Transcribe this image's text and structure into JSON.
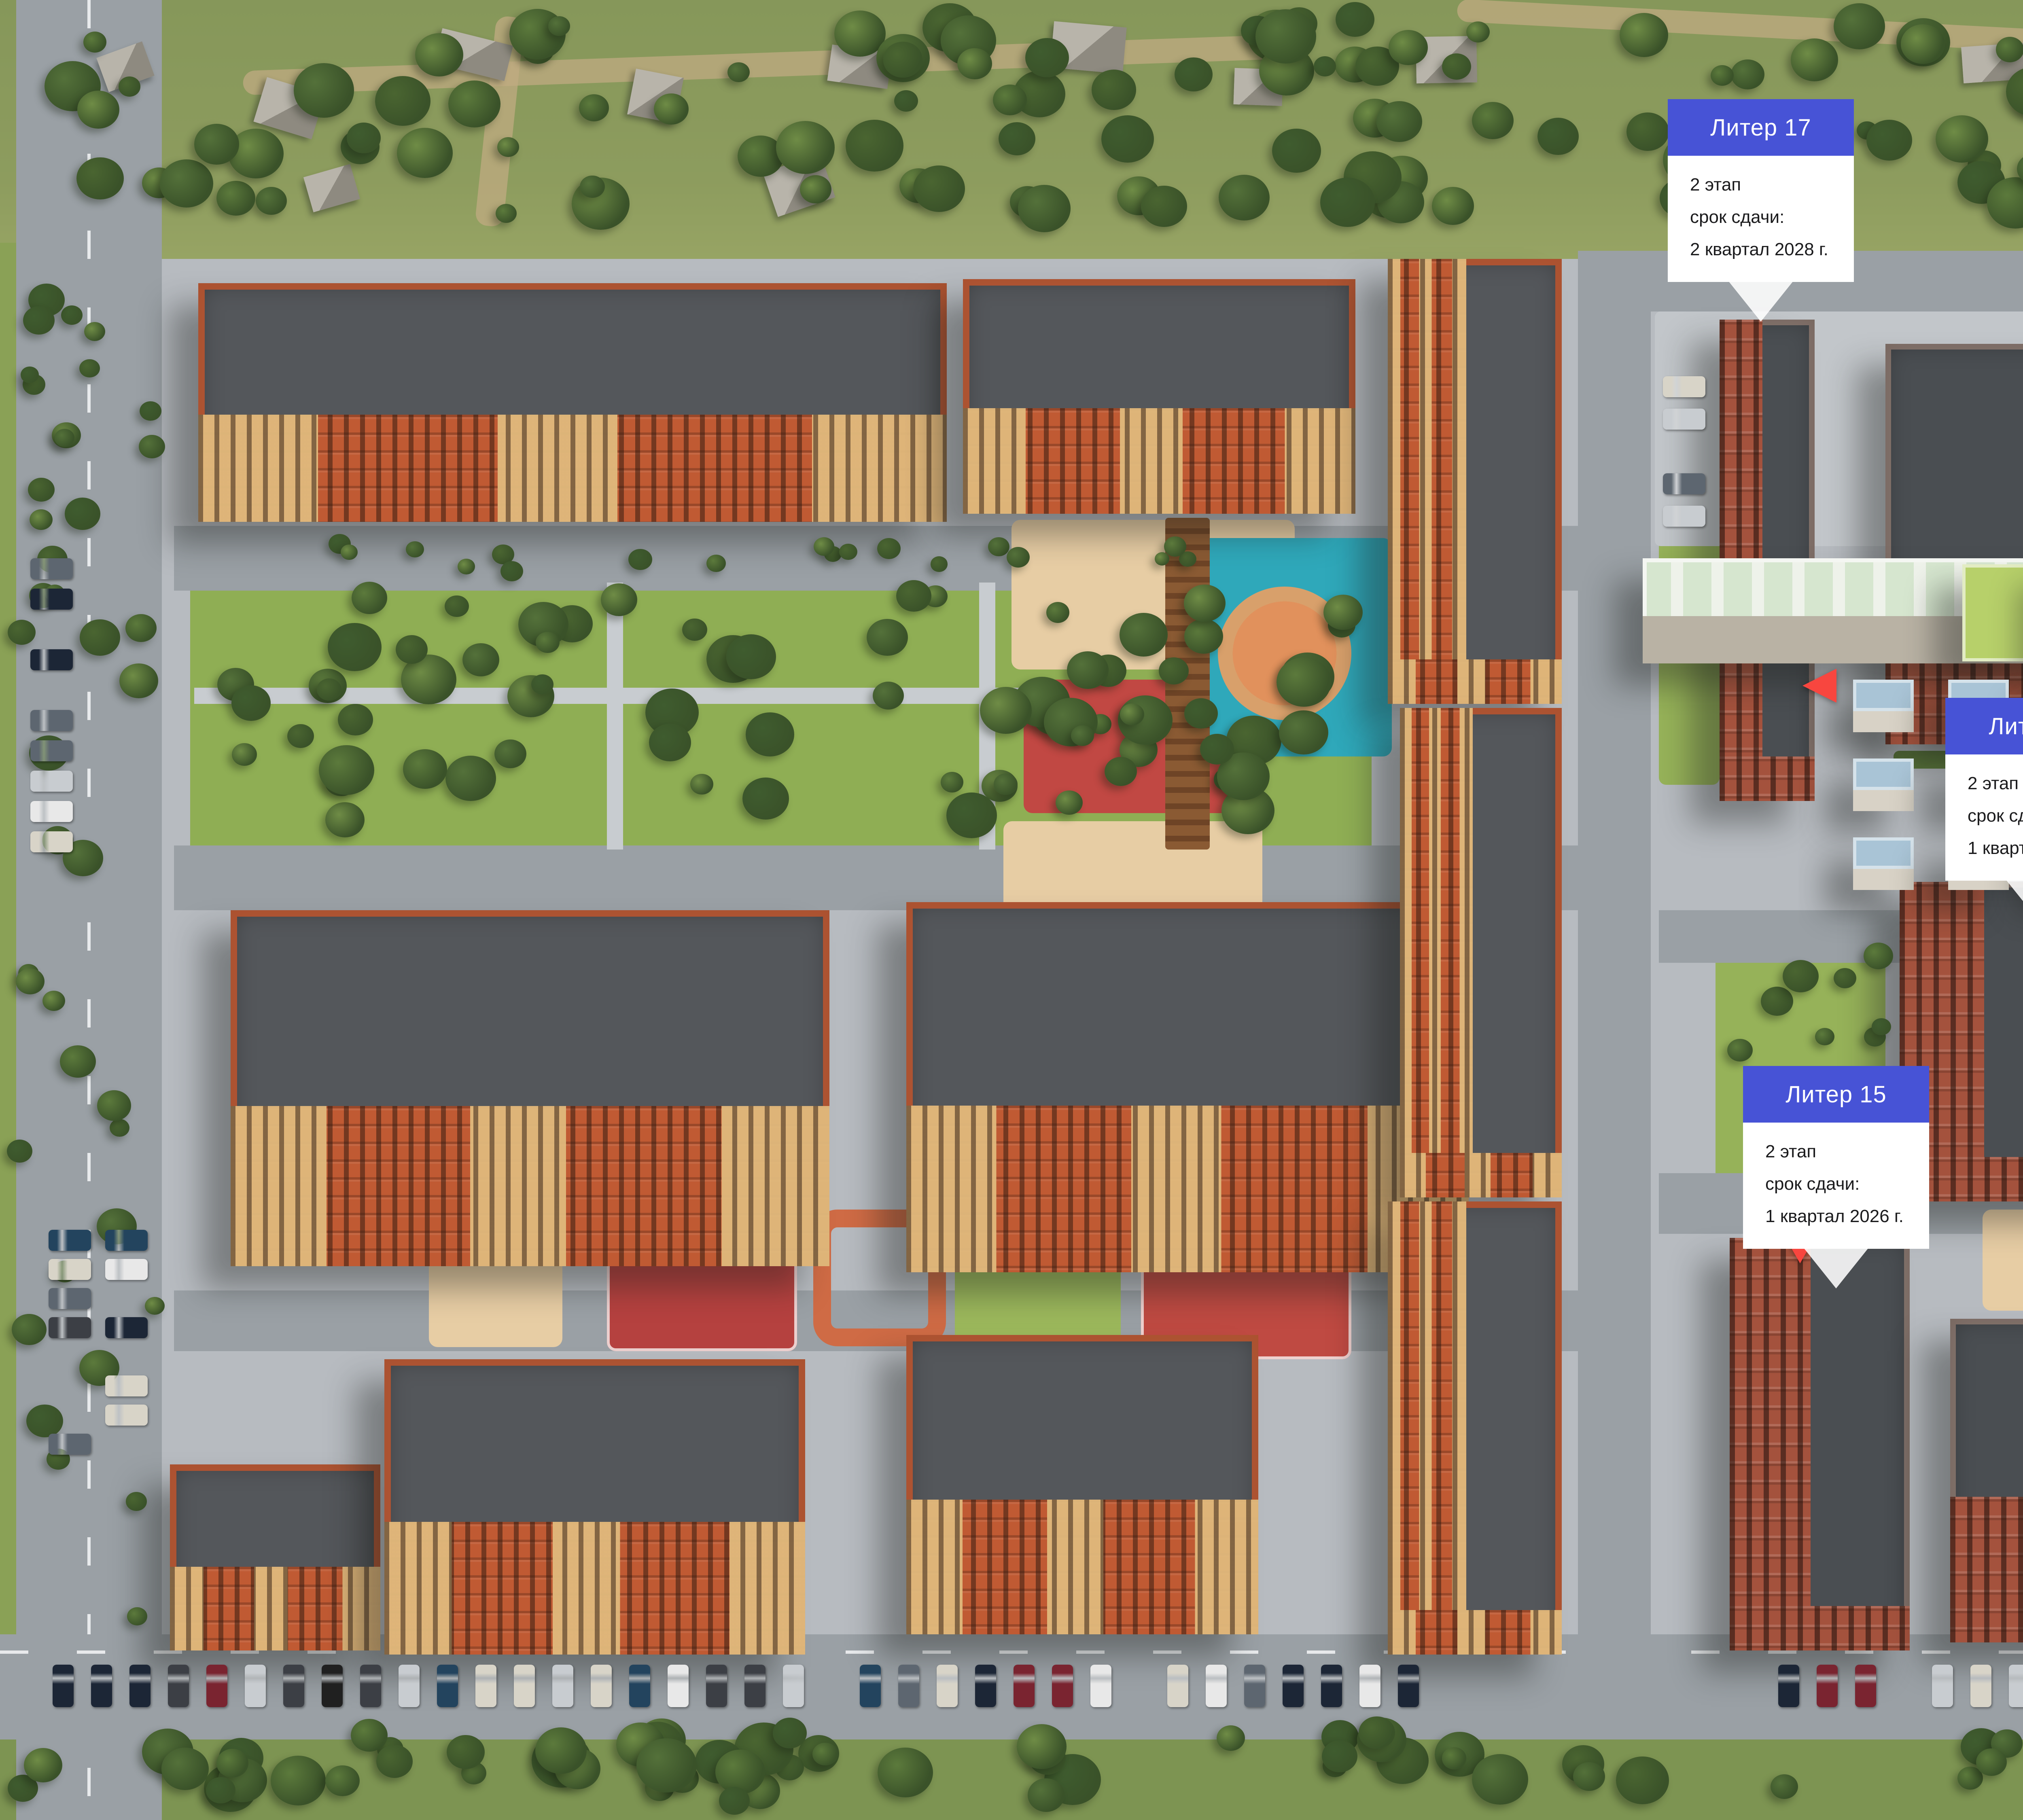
{
  "colors": {
    "accent_blue": "#4753D6",
    "entrance_marker_red": "#F8463F",
    "selected_building_highlight": "#5A60D6",
    "card_body": "#FFFFFF",
    "card_text": "#1B1B1D"
  },
  "icons": {
    "entrance_marker": "red-triangle",
    "callout_tail": "white-triangle-down"
  },
  "callouts": [
    {
      "id": "liter-17",
      "title": "Литер 17",
      "stage": "2 этап",
      "deadline_label": "срок сдачи:",
      "deadline": "2 квартал 2028 г."
    },
    {
      "id": "liter-18",
      "title": "Литер 18",
      "stage": "2 этап",
      "deadline_label": "срок сдачи:",
      "deadline": "2 квартал 2028 г."
    },
    {
      "id": "liter-19",
      "title": "Литер 19",
      "stage": "2 этап",
      "deadline_label": "срок сдачи:",
      "deadline": "2 квартал 2028 г."
    },
    {
      "id": "liter-20",
      "title": "Литер 20",
      "stage": "2 этап",
      "deadline_label": "срок сдачи:",
      "deadline": "2 квартал 2028 г."
    },
    {
      "id": "liter-11",
      "title": "Литер 11",
      "stage": "2 этап",
      "deadline_label": "срок сдачи:",
      "deadline": "1 квартал 2026 г."
    },
    {
      "id": "liter-12",
      "title": "Литер 12",
      "stage": "2 этап",
      "deadline_label": "срок сдачи:",
      "deadline": "4 квартал 2026 г."
    },
    {
      "id": "liter-12-east",
      "title": "Литер 12",
      "stage": "2 этап",
      "deadline_label": "срок сдачи:",
      "deadline": "4 квартал 2026 г."
    },
    {
      "id": "liter-15",
      "title": "Литер 15",
      "stage": "2 этап",
      "deadline_label": "срок сдачи:",
      "deadline": "1 квартал 2026 г."
    },
    {
      "id": "liter-14",
      "title": "Литер 14",
      "stage": "2 этап",
      "deadline_label": "срок сдачи:",
      "deadline": "1 квартал 2026 г."
    }
  ]
}
